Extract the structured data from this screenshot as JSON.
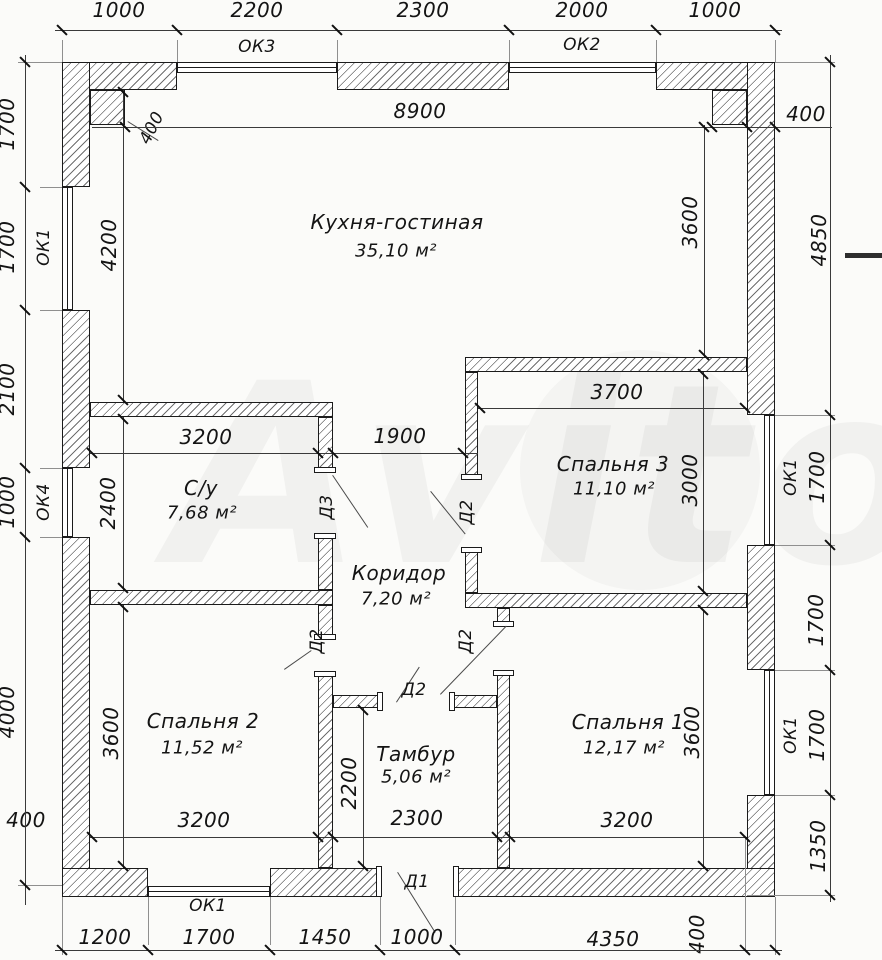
{
  "watermark": "Avito",
  "rooms": {
    "kitchen": {
      "name": "Кухня-гостиная",
      "area": "35,10 м²"
    },
    "bathroom": {
      "name": "С/у",
      "area": "7,68 м²"
    },
    "corridor": {
      "name": "Коридор",
      "area": "7,20 м²"
    },
    "bedroom3": {
      "name": "Спальня 3",
      "area": "11,10 м²"
    },
    "bedroom2": {
      "name": "Спальня 2",
      "area": "11,52 м²"
    },
    "vestibule": {
      "name": "Тамбур",
      "area": "5,06 м²"
    },
    "bedroom1": {
      "name": "Спальня 1",
      "area": "12,17 м²"
    }
  },
  "windows": {
    "ok1": "ОК1",
    "ok2": "ОК2",
    "ok3": "ОК3",
    "ok4": "ОК4"
  },
  "doors": {
    "d1": "Д1",
    "d2": "Д2",
    "d3": "Д3"
  },
  "dims": {
    "top": [
      "1000",
      "2200",
      "2300",
      "2000",
      "1000"
    ],
    "left": [
      "1700",
      "1700",
      "2100",
      "1000",
      "4000",
      "400"
    ],
    "right": [
      "400",
      "4850",
      "1700",
      "1700",
      "1700",
      "1350"
    ],
    "bottom": [
      "1200",
      "1700",
      "1450",
      "1000",
      "4350",
      "400"
    ],
    "kitchen": {
      "width": "8900",
      "left_depth": "4200",
      "right_depth": "3600",
      "pier": "400"
    },
    "bathroom": {
      "width": "3200",
      "depth": "2400"
    },
    "corridor": {
      "opening": "1900"
    },
    "bedroom3": {
      "width": "3700",
      "depth": "3000"
    },
    "bedroom2": {
      "width": "3200",
      "depth": "3600"
    },
    "vestibule": {
      "width": "2300",
      "depth": "2200"
    },
    "bedroom1": {
      "width": "3200",
      "depth": "3600"
    }
  }
}
